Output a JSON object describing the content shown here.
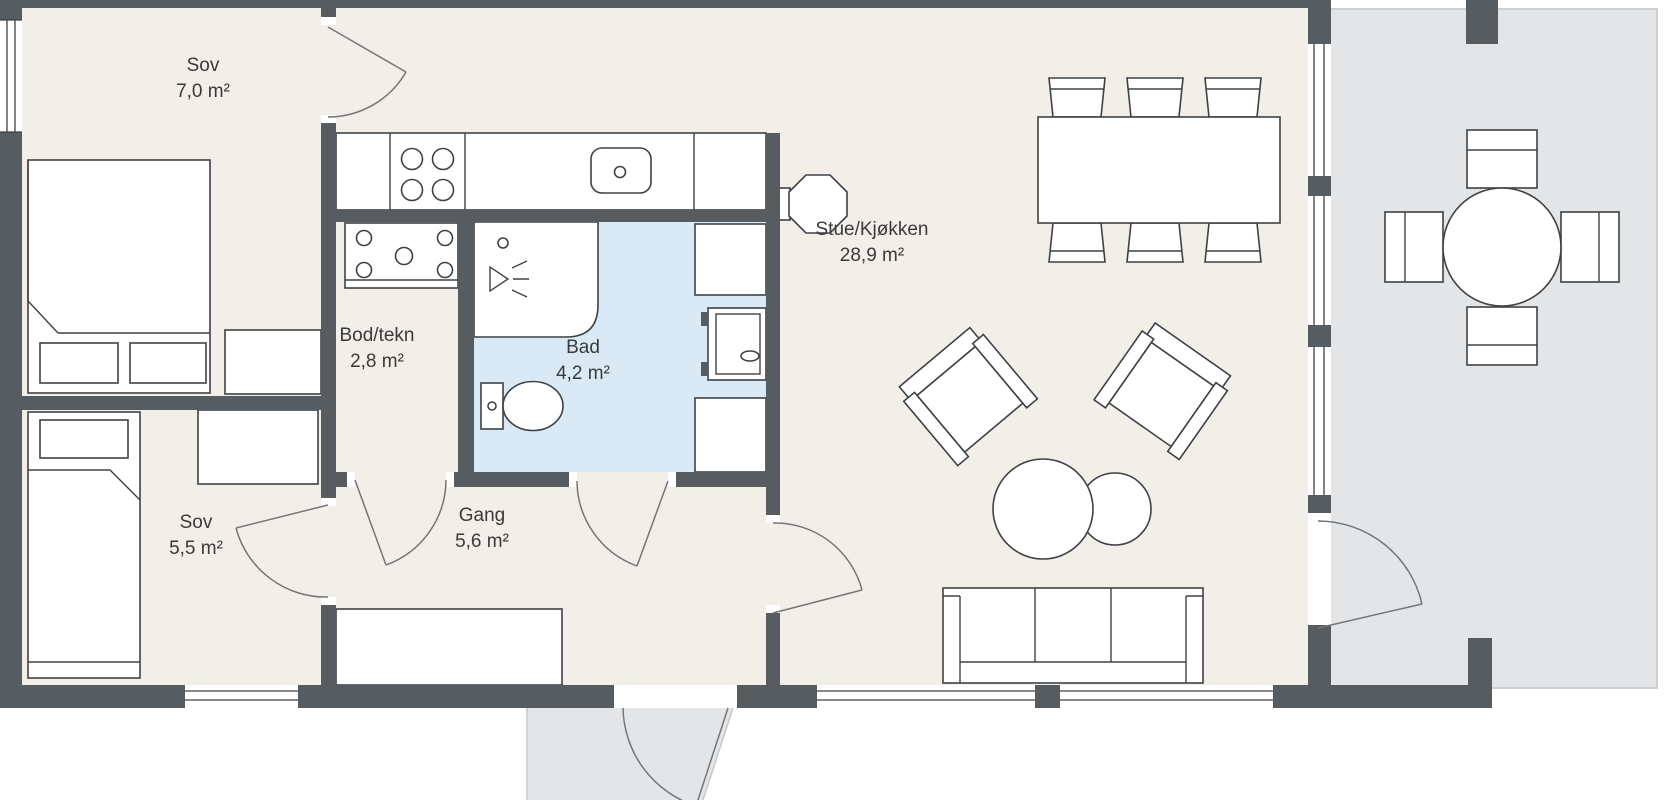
{
  "plan_title": "Floor plan",
  "rooms": [
    {
      "name": "Sov",
      "area": "7,0 m²"
    },
    {
      "name": "Bod/tekn",
      "area": "2,8 m²"
    },
    {
      "name": "Bad",
      "area": "4,2 m²"
    },
    {
      "name": "Stue/Kjøkken",
      "area": "28,9 m²"
    },
    {
      "name": "Sov",
      "area": "5,5 m²"
    },
    {
      "name": "Gang",
      "area": "5,6 m²"
    }
  ],
  "colors": {
    "wall": "#575c61",
    "floor": "#f2efe8",
    "bath": "#d9eaf6",
    "outdoor": "#e4e5e7",
    "stroke": "#3e4245",
    "door": "#73777a",
    "label": "#3a3a3a",
    "bg": "#ffffff"
  }
}
